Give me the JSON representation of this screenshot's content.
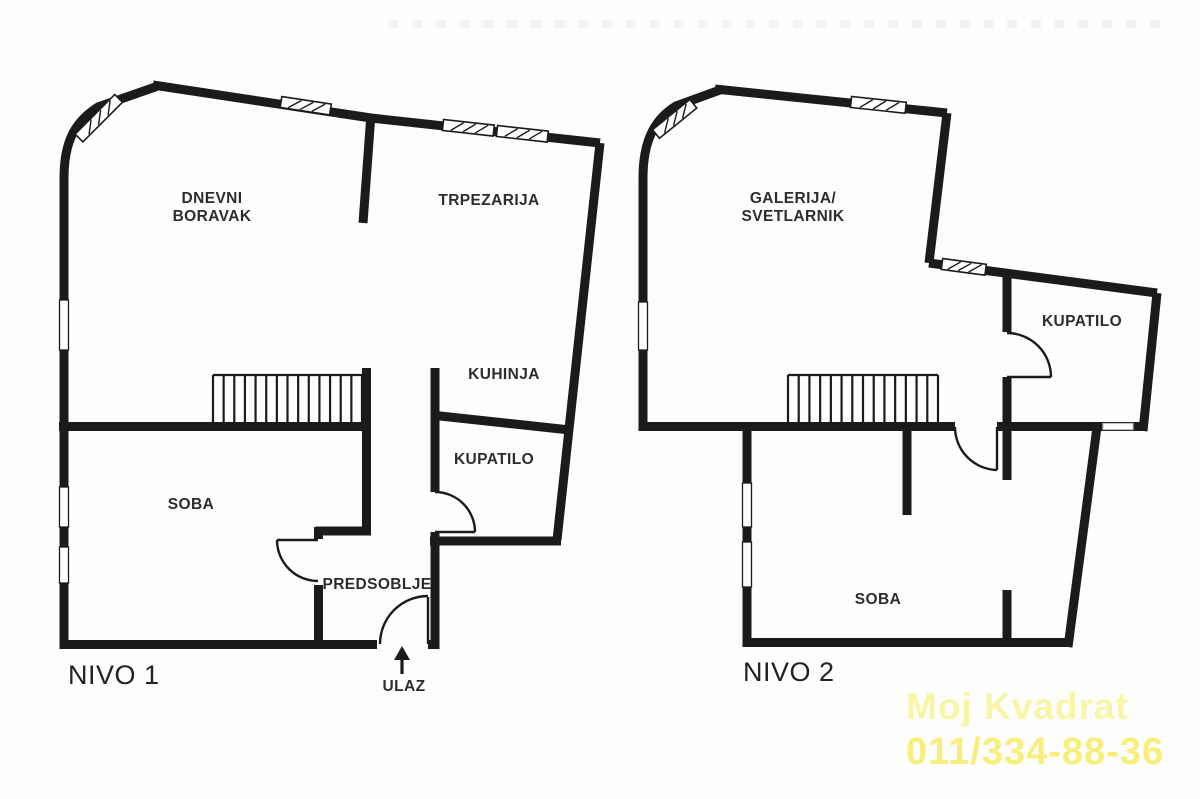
{
  "page": {
    "background": "#fdfdfc",
    "wall_color": "#1b1b1b"
  },
  "plans": [
    {
      "id": "nivo-1",
      "label": "NIVO 1",
      "rooms": [
        {
          "id": "dnevni-boravak",
          "line1": "DNEVNI",
          "line2": "BORAVAK"
        },
        {
          "id": "trpezarija",
          "label": "TRPEZARIJA"
        },
        {
          "id": "kuhinja",
          "label": "KUHINJA"
        },
        {
          "id": "kupatilo",
          "label": "KUPATILO"
        },
        {
          "id": "soba",
          "label": "SOBA"
        },
        {
          "id": "predsoblje",
          "label": "PREDSOBLJE"
        }
      ],
      "entrance_label": "ULAZ"
    },
    {
      "id": "nivo-2",
      "label": "NIVO 2",
      "rooms": [
        {
          "id": "galerija-svetlarnik",
          "line1": "GALERIJA/",
          "line2": "SVETLARNIK"
        },
        {
          "id": "kupatilo",
          "label": "KUPATILO"
        },
        {
          "id": "soba",
          "label": "SOBA"
        }
      ]
    }
  ],
  "watermark": {
    "line1": "Moj Kvadrat",
    "line2": "011/334-88-36",
    "color_line1": "#f9f5a6",
    "color_line2": "#f7ee7c"
  }
}
